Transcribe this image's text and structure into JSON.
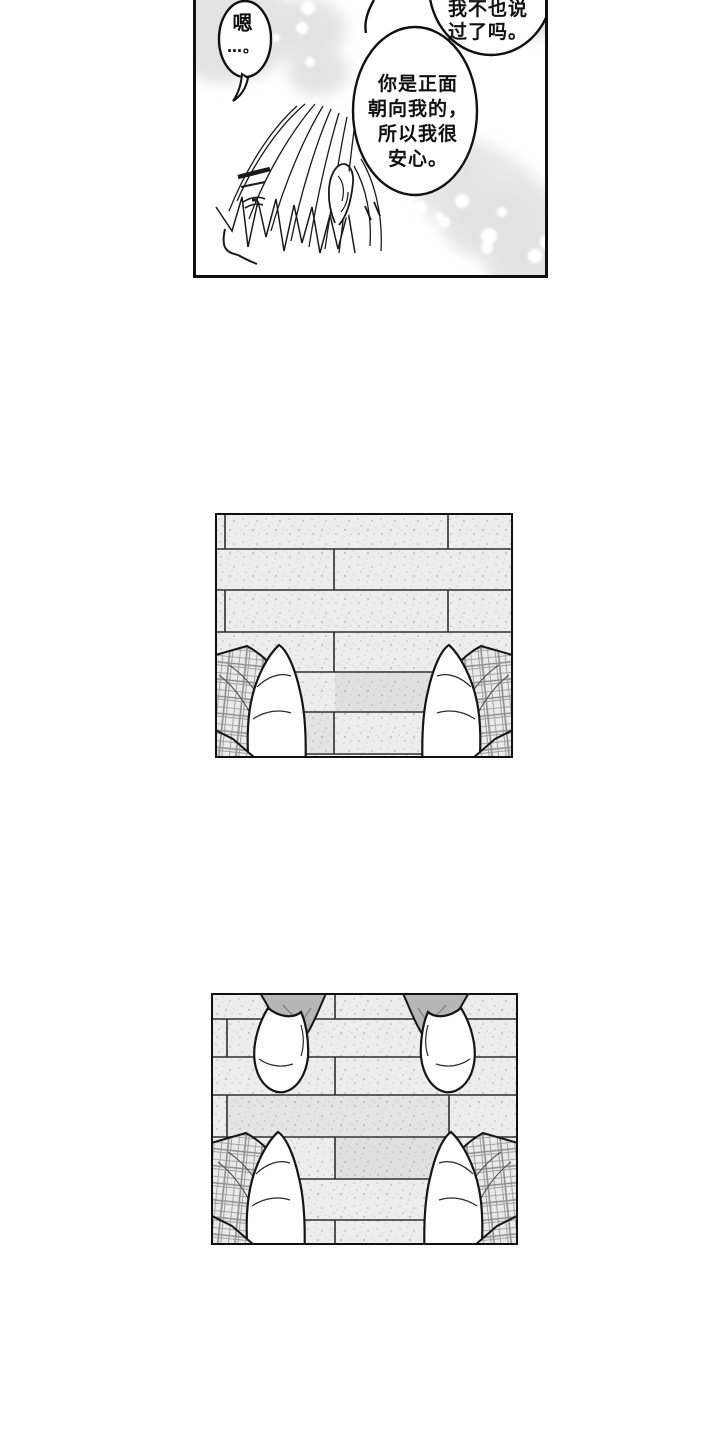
{
  "panel1": {
    "bubble_top": {
      "line1": "我不也说",
      "line2": "过了吗。"
    },
    "bubble_main": {
      "line1": "你是正面",
      "line2": "朝向我的，",
      "line3": "所以我很",
      "line4": "安心。"
    },
    "bubble_small": {
      "line1": "嗯",
      "line2": "…。"
    }
  },
  "colors": {
    "ink": "#1a1a1a",
    "panel_border": "#101010",
    "paper": "#ffffff",
    "tile_fill": "#ededed",
    "tile_line": "#2e2e2e",
    "plaid_line": "#8d8d8d",
    "pant_gray": "#b6b6b6",
    "bokeh_gray": "#c9c9c9"
  }
}
